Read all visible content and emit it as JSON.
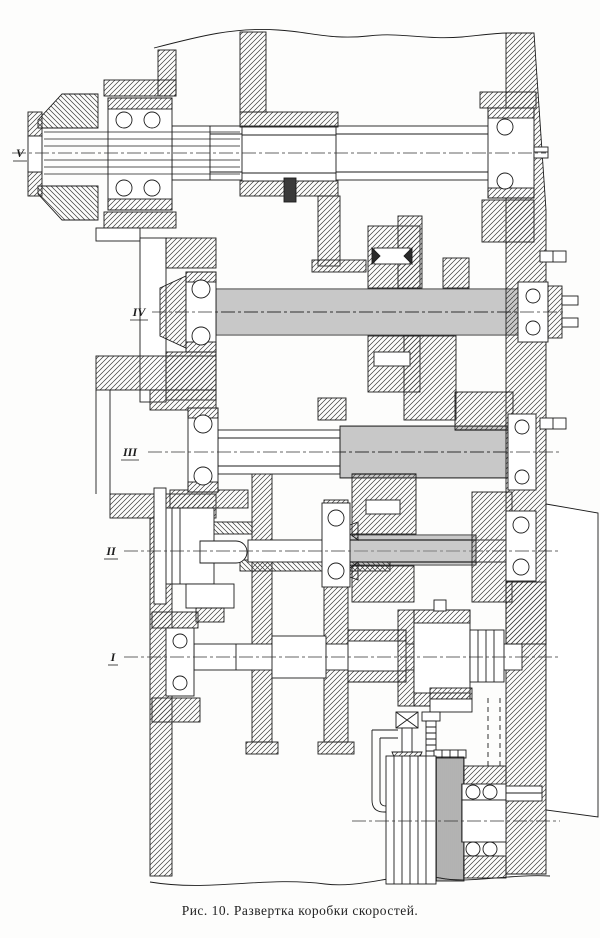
{
  "figure": {
    "caption": "Рис. 10. Развертка коробки скоростей."
  },
  "drawing": {
    "type": "technical-sectional-drawing",
    "shaft_labels": [
      "V",
      "IV",
      "III",
      "II",
      "I"
    ],
    "colors": {
      "ink": "#1c1c1c",
      "paper": "#ffffff"
    }
  }
}
